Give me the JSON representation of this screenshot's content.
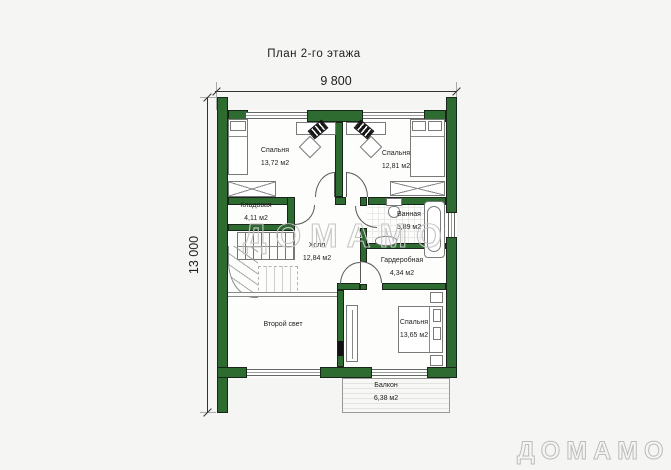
{
  "title": "План 2-го этажа",
  "dimensions": {
    "width_label": "9 800",
    "height_label": "13 000"
  },
  "rooms": {
    "bedroom1": {
      "name": "Спальня",
      "area": "13,72 м2"
    },
    "bedroom2": {
      "name": "Спальня",
      "area": "12,81 м2"
    },
    "storage": {
      "name": "Кладовая",
      "area": "4,11 м2"
    },
    "bathroom": {
      "name": "Ванная",
      "area": "5,89 м2"
    },
    "hall": {
      "name": "Холл",
      "area": "12,84 м2"
    },
    "wardrobe": {
      "name": "Гардеробная",
      "area": "4,34 м2"
    },
    "bedroom3": {
      "name": "Спальня",
      "area": "13,65 м2"
    },
    "second_light": {
      "name": "Второй свет"
    },
    "balcony": {
      "name": "Балкон",
      "area": "6,38 м2"
    }
  },
  "watermark": {
    "center": "ДОМАМО",
    "corner": "ДОМАМО"
  },
  "colors": {
    "wall_green": "#2e6b31",
    "background": "#f5f5f3",
    "watermark_gray": "#c5c5c5"
  }
}
